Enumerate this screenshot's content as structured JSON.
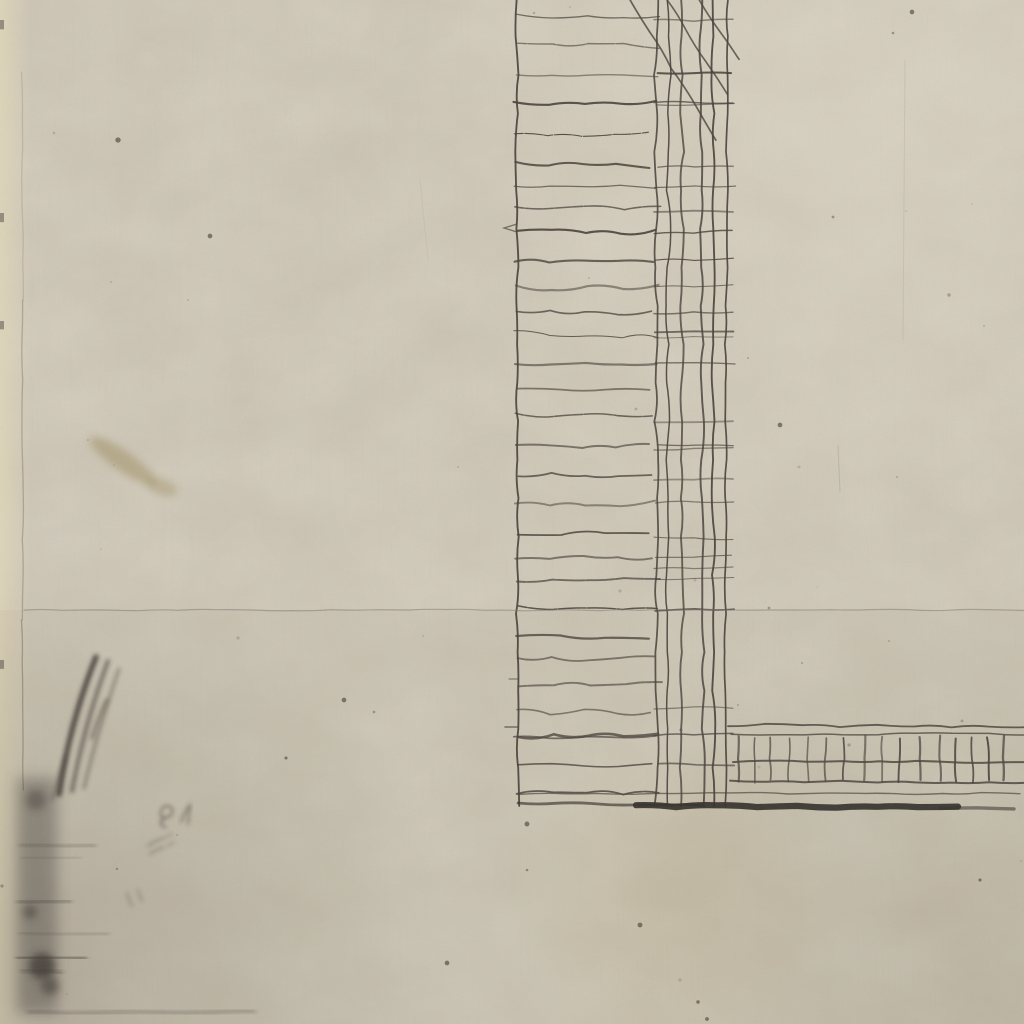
{
  "meta": {
    "title": "Scanned detail of an antique etching: cross-hatched L-shaped wall section on aged paper",
    "content_type": "engraving-scan",
    "has_text": false
  },
  "palette": {
    "paper": "#cdc6b5",
    "paper_light": "#dad3c3",
    "paper_cream_edge": "#ddd4ba",
    "ink": "#48413a",
    "ink_grid": "#443d37",
    "ink_heavy": "#2f2b27",
    "faint_rule": "#827a6e",
    "plate_edge": "#6e665a",
    "pencil": "#38332e",
    "stain_brown": "#9b8a5d",
    "speck": "#55504a"
  },
  "drawing": {
    "hatch_column": {
      "left": 516,
      "right_end_min": 648,
      "right_end_var": 14,
      "top": 12,
      "bottom": 802,
      "spacing_min": 21,
      "spacing_var": 10,
      "grid_left": 654,
      "grid_right": 731
    },
    "grid": {
      "verticals": [
        517,
        656,
        669,
        682,
        701,
        713,
        727
      ],
      "top": 0,
      "bottom": 806
    },
    "diagonals": [
      [
        628,
        -4,
        716,
        140
      ],
      [
        665,
        -4,
        727,
        95
      ],
      [
        697,
        -4,
        738,
        60
      ]
    ],
    "band": {
      "x0": 728,
      "x1": 1026,
      "top1": 725,
      "top2": 734,
      "hatch_top": 737,
      "hatch_bottom": 781,
      "mid": 761,
      "bottom": 781,
      "hatch_step_min": 15,
      "hatch_step_var": 6
    },
    "thin_underline": {
      "x0": 518,
      "x1": 1020,
      "y": 793.5
    },
    "heavy_line_segments": [
      {
        "x0": 518,
        "x1": 702,
        "y": 803.5,
        "w": 2.8,
        "o": 0.65
      },
      {
        "x0": 636,
        "x1": 958,
        "y": 806,
        "w": 6.2,
        "o": 0.92
      },
      {
        "x0": 940,
        "x1": 1014,
        "y": 807.5,
        "w": 3.4,
        "o": 0.55
      }
    ],
    "rule_line": {
      "x0": 24,
      "x1": 1024,
      "y": 610
    },
    "plate_edge_segments": [
      {
        "y0": 72,
        "y1": 300,
        "o": 0.22
      },
      {
        "y0": 300,
        "y1": 620,
        "o": 0.4
      },
      {
        "y0": 620,
        "y1": 790,
        "o": 0.5
      }
    ],
    "plate_edge_x": 22,
    "edge_hooks": [
      {
        "d": "M517 224 l-13 4 l13 4",
        "w": 1.3,
        "o": 0.7
      },
      {
        "d": "M505 727 h13",
        "w": 1.5,
        "o": 0.7
      },
      {
        "d": "M509 679 h9",
        "w": 1.2,
        "o": 0.6
      }
    ],
    "bold_hatch_line": {
      "x0": 519,
      "y0": 736,
      "x1": 658,
      "y1": 733,
      "amp": 7,
      "w": 2.6,
      "o": 0.8
    }
  },
  "artifacts": {
    "pencil_strokes": [
      {
        "d": "M59 794 Q70 722 96 657",
        "w": 5.5,
        "o": 0.85
      },
      {
        "d": "M72 791 Q84 726 108 661",
        "w": 4,
        "o": 0.6
      },
      {
        "d": "M84 788 Q97 733 119 669",
        "w": 2.6,
        "o": 0.5
      },
      {
        "d": "M92 738 Q99 716 107 700",
        "w": 3.2,
        "o": 0.5
      },
      {
        "d": "M52 800 Q58 780 66 757",
        "w": 2.2,
        "o": 0.45
      }
    ],
    "scribbles": [
      {
        "d": "M165 819 c-7 -2 -5 -13 2 -13 c8 0 7 10 0 11 c-7 1 -9 9 -1 10",
        "w": 1.8,
        "o": 0.7
      },
      {
        "d": "M181 822 q4 -11 9 -17 l-2 19",
        "w": 1.8,
        "o": 0.65
      },
      {
        "d": "M148 846 q8 -6 16 -8 m-14 16 q7 -5 14 -7",
        "w": 1.6,
        "o": 0.55
      },
      {
        "d": "M166 837 l6 -3 m-4 12 l6 -4",
        "w": 1.4,
        "o": 0.5
      },
      {
        "d": "M127 893 q2 8 5 13 m6 -16 q2 7 4 11",
        "w": 1.6,
        "o": 0.45
      }
    ],
    "smudge_band": {
      "x": 17,
      "y": 778,
      "w": 40,
      "h": 235,
      "o": 0.38
    },
    "smudge_streaks": [
      {
        "x0": 20,
        "x1": 95,
        "y": 845,
        "w": 3,
        "o": 0.35
      },
      {
        "x0": 22,
        "x1": 80,
        "y": 858,
        "w": 2,
        "o": 0.3
      },
      {
        "x0": 18,
        "x1": 70,
        "y": 902,
        "w": 4,
        "o": 0.4
      },
      {
        "x0": 20,
        "x1": 108,
        "y": 933,
        "w": 2.5,
        "o": 0.3
      },
      {
        "x0": 18,
        "x1": 85,
        "y": 958,
        "w": 5,
        "o": 0.5
      },
      {
        "x0": 22,
        "x1": 62,
        "y": 970,
        "w": 3,
        "o": 0.45
      },
      {
        "x0": 28,
        "x1": 255,
        "y": 1013,
        "w": 2.2,
        "o": 0.5
      }
    ],
    "smudge_blobs": [
      {
        "cx": 42,
        "cy": 966,
        "r": 13,
        "o": 0.75
      },
      {
        "cx": 30,
        "cy": 912,
        "r": 7,
        "o": 0.5
      },
      {
        "cx": 50,
        "cy": 986,
        "r": 9,
        "o": 0.55
      },
      {
        "cx": 36,
        "cy": 800,
        "r": 10,
        "o": 0.4
      }
    ],
    "brown_stains": [
      {
        "cx": 123,
        "cy": 461,
        "rx": 40,
        "ry": 10,
        "rot": 35,
        "o": 0.5
      },
      {
        "cx": 162,
        "cy": 487,
        "rx": 16,
        "ry": 8,
        "rot": 20,
        "o": 0.4
      }
    ],
    "edge_ticks": [
      20,
      213,
      321,
      660
    ],
    "fixed_specks": [
      [
        447,
        963
      ],
      [
        286,
        758
      ],
      [
        527,
        824
      ],
      [
        698,
        1002
      ],
      [
        707,
        1019
      ],
      [
        780,
        425
      ],
      [
        912,
        12
      ],
      [
        344,
        700
      ],
      [
        118,
        140
      ],
      [
        210,
        236
      ],
      [
        640,
        925
      ],
      [
        980,
        880
      ]
    ],
    "scratches": [
      {
        "d": "M905 60 L903 340",
        "o": 0.12
      },
      {
        "d": "M838 446 L840 492",
        "o": 0.2
      },
      {
        "d": "M420 180 L428 260",
        "o": 0.08
      }
    ],
    "random_speck_count": 42
  }
}
